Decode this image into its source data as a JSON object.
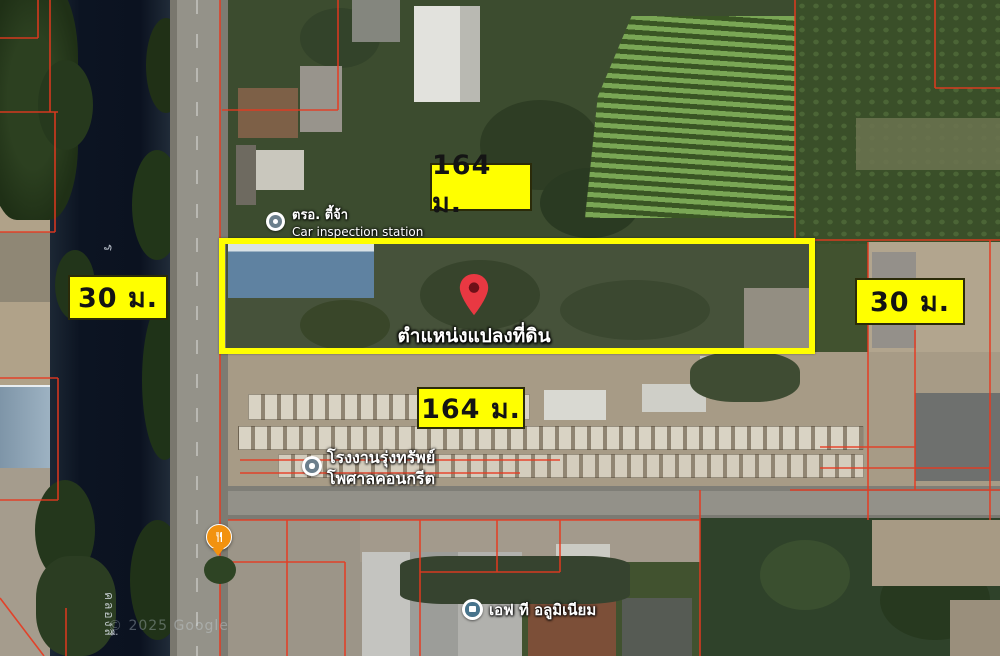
{
  "annotations": {
    "top_width_label": "164 ม.",
    "bottom_width_label": "164 ม.",
    "left_depth_label": "30 ม.",
    "right_depth_label": "30 ม.",
    "pin_caption": "ตำแหน่งแปลงที่ดิน",
    "highlight_color": "#ffff00",
    "parcel_line_color": "#e8391f",
    "pin_color": "#e93842"
  },
  "pois": {
    "car_inspection": {
      "name_th": "ตรอ. ตี้จ้า",
      "name_en": "Car inspection station"
    },
    "factory": {
      "line1": "โรงงานรุ่งทรัพย์",
      "line2": "โพศาลคอนกรีต"
    },
    "aluminium": {
      "name": "เอฟ ที อลูมิเนียม"
    }
  },
  "map": {
    "canal_label_fragment": "ร",
    "canal_label": "คลองสี่",
    "attribution": "© 2025 Google"
  }
}
